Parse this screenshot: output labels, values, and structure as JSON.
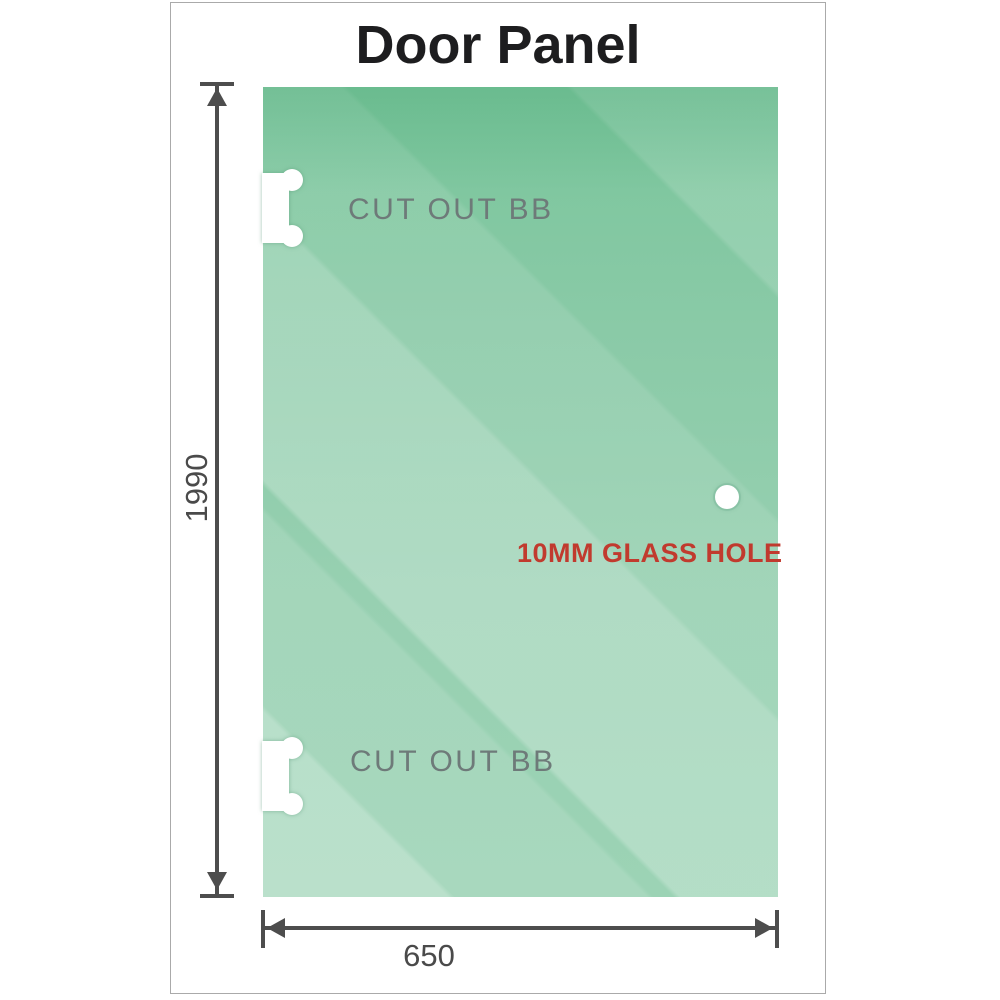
{
  "title": "Door Panel",
  "panel": {
    "cutout_top_label": "CUT OUT BB",
    "cutout_bottom_label": "CUT OUT BB",
    "glass_hole_label": "10MM GLASS HOLE"
  },
  "dimensions": {
    "height_label": "1990",
    "width_label": "650"
  },
  "colors": {
    "glass_green_dark": "#79c59b",
    "glass_green_light": "#b9e2cc",
    "dimension_line": "#4d4d4d",
    "cutout_text_gray": "#6e7a79",
    "hole_text_red": "#c13a2e",
    "title_text": "#1d1d1f",
    "frame_border": "#aaaaaa"
  }
}
